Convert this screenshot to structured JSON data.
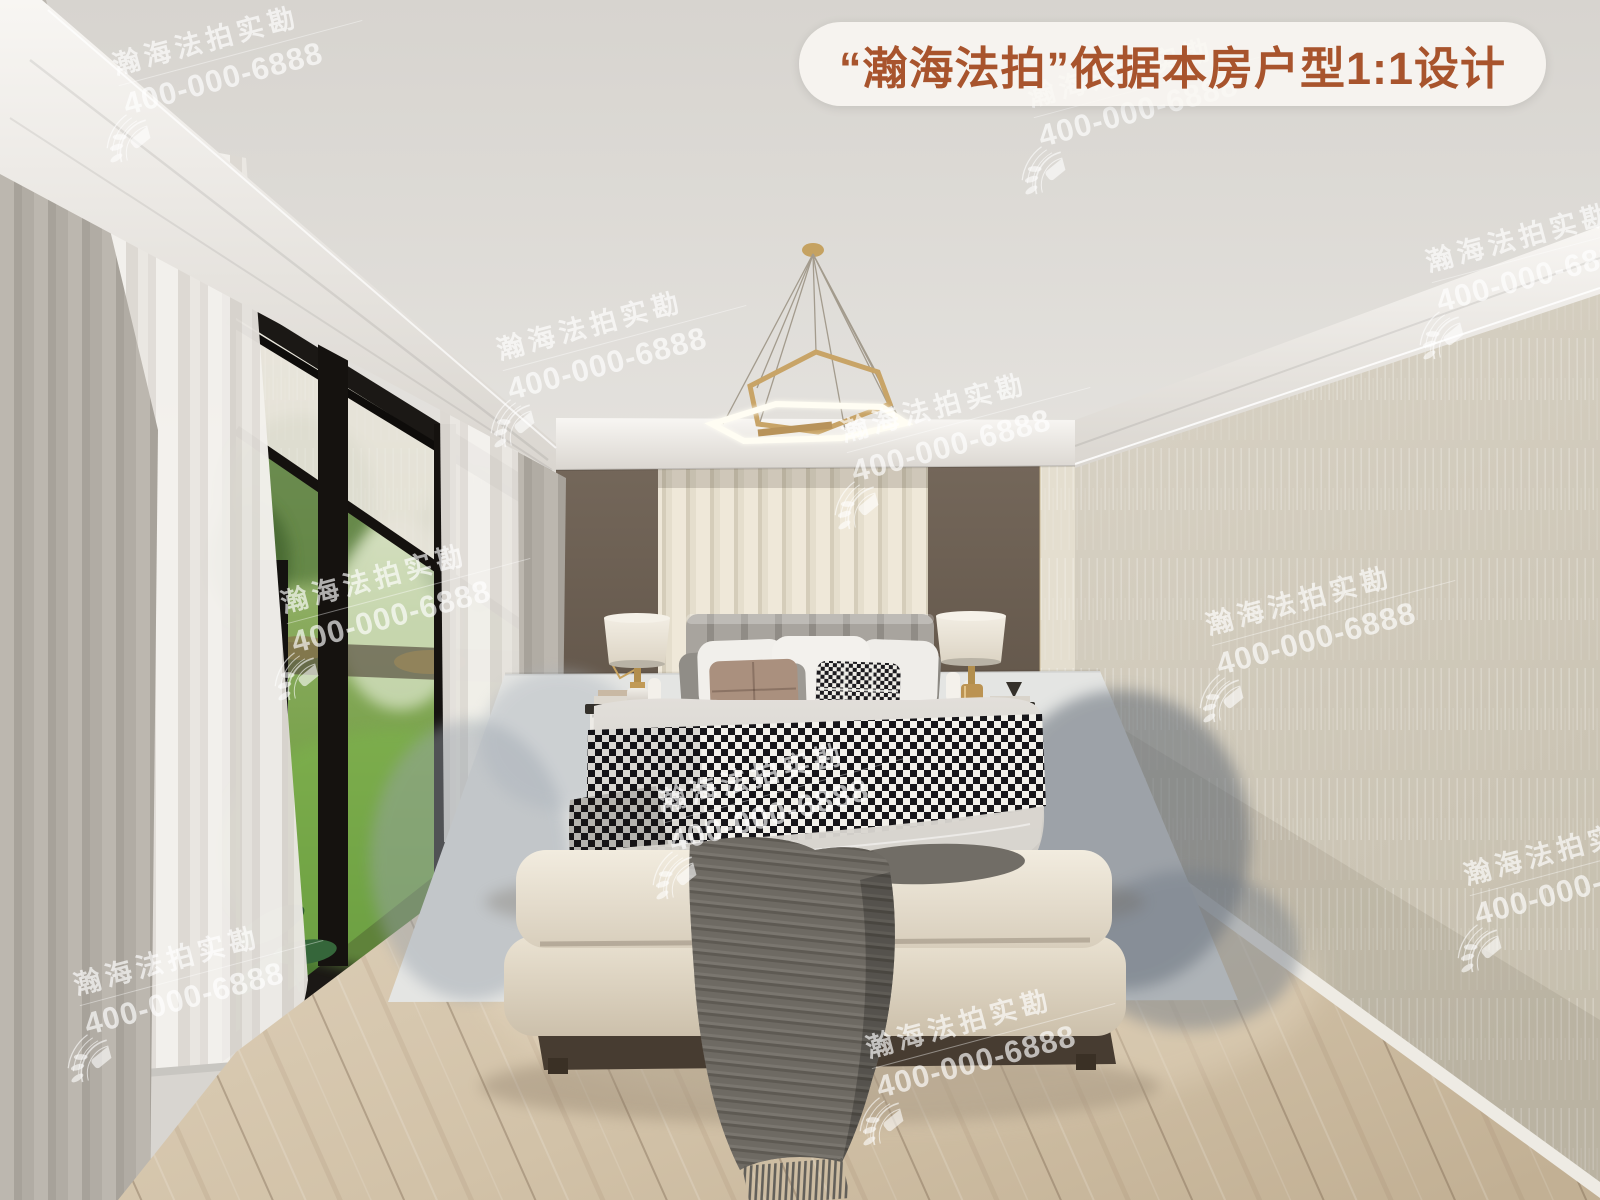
{
  "banner": {
    "text": "“瀚海法拍”依据本房户型1:1设计",
    "text_color": "#a8542d",
    "background_color": "#f7f5f0"
  },
  "watermark": {
    "brand": "瀚海法拍实勘",
    "phone": "400-000-6888",
    "color": "#ffffff"
  }
}
